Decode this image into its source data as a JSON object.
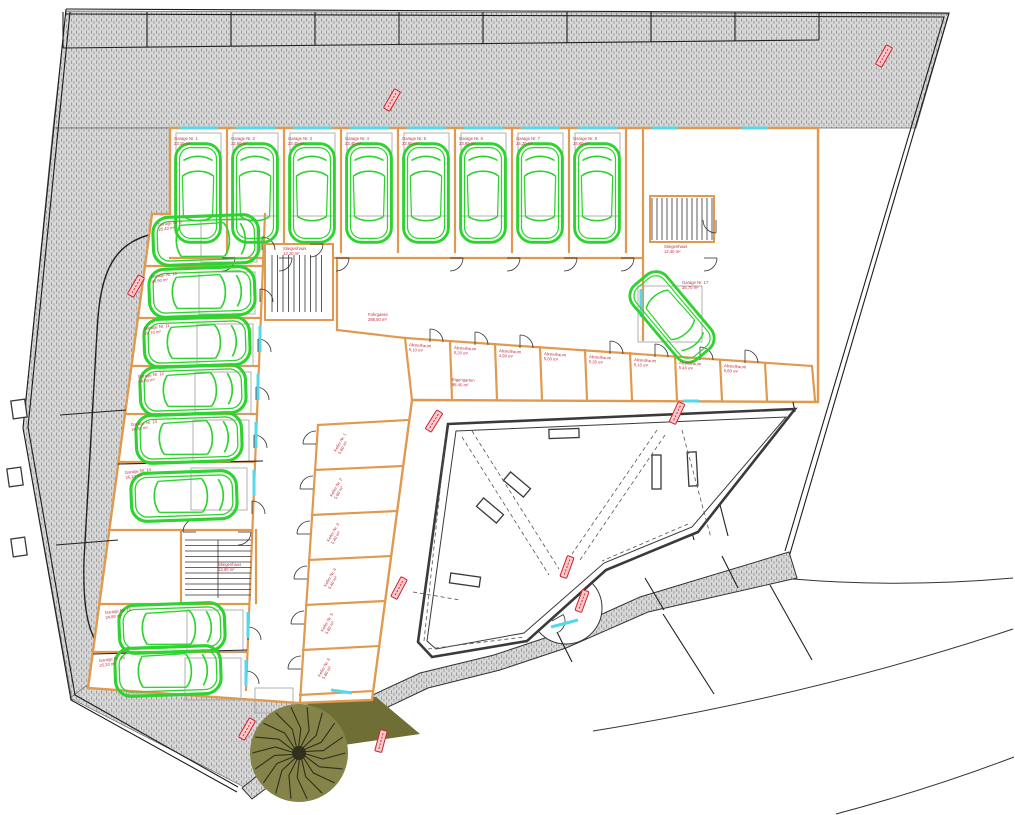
{
  "colors": {
    "wall": "#e09a50",
    "car": "#2fd32f",
    "window": "#55d8ea",
    "stamp": "#cc2233",
    "label": "#c03344",
    "hatch_bg": "#d8d8d8",
    "hatch_mark": "#9b9b9b",
    "courtyard_wall": "#3a3a3a",
    "olive": "#6e6e35",
    "tree_branches": "#30301c",
    "boundary": "#1d1d1d"
  },
  "top_stalls": {
    "x0": 63,
    "n": 9,
    "w": 84,
    "y_top": 12,
    "y_bot_left": 48,
    "y_bot_right": 40
  },
  "cars": [
    [
      198,
      193,
      0,
      1.12
    ],
    [
      255,
      193,
      0,
      1.12
    ],
    [
      312,
      193,
      0,
      1.12
    ],
    [
      369,
      193,
      0,
      1.12
    ],
    [
      426,
      193,
      0,
      1.12
    ],
    [
      483,
      193,
      0,
      1.12
    ],
    [
      540,
      193,
      0,
      1.12
    ],
    [
      597,
      193,
      0,
      1.12
    ],
    [
      206,
      240,
      88,
      1.2
    ],
    [
      202,
      292,
      88,
      1.2
    ],
    [
      197,
      342,
      88,
      1.2
    ],
    [
      193,
      390,
      88,
      1.2
    ],
    [
      189,
      438,
      88,
      1.2
    ],
    [
      184,
      496,
      88,
      1.2
    ],
    [
      172,
      628,
      88,
      1.2
    ],
    [
      168,
      671,
      88,
      1.2
    ],
    [
      672,
      317,
      140,
      1.1
    ]
  ],
  "walls": [
    [
      170,
      258,
      643,
      258
    ],
    [
      227,
      128,
      227,
      252
    ],
    [
      284,
      128,
      284,
      252
    ],
    [
      341,
      128,
      341,
      252
    ],
    [
      398,
      128,
      398,
      252
    ],
    [
      455,
      128,
      455,
      252
    ],
    [
      512,
      128,
      512,
      252
    ],
    [
      569,
      128,
      569,
      252
    ],
    [
      626,
      128,
      626,
      252
    ],
    [
      265,
      214,
      246,
      690
    ],
    [
      145,
      266,
      263,
      266
    ],
    [
      138,
      318,
      261,
      318
    ],
    [
      132,
      366,
      259,
      366
    ],
    [
      125,
      414,
      257,
      414
    ],
    [
      119,
      462,
      255,
      462
    ],
    [
      109,
      530,
      252,
      530
    ],
    [
      99,
      604,
      249,
      604
    ],
    [
      93,
      652,
      247,
      652
    ],
    [
      337,
      258,
      337,
      330
    ],
    [
      337,
      330,
      405,
      338
    ],
    [
      405,
      338,
      812,
      366
    ],
    [
      405,
      338,
      412,
      400
    ],
    [
      450,
      341,
      452,
      400
    ],
    [
      495,
      344,
      497,
      400
    ],
    [
      540,
      347,
      542,
      400
    ],
    [
      585,
      350,
      587,
      400
    ],
    [
      630,
      353,
      632,
      400
    ],
    [
      675,
      357,
      677,
      400
    ],
    [
      720,
      360,
      722,
      400
    ],
    [
      765,
      363,
      767,
      400
    ],
    [
      812,
      366,
      815,
      400
    ],
    [
      643,
      128,
      643,
      340
    ],
    [
      318,
      425,
      300,
      702
    ],
    [
      318,
      425,
      408,
      420
    ],
    [
      315,
      470,
      403,
      466
    ],
    [
      312,
      515,
      397,
      511
    ],
    [
      309,
      560,
      391,
      556
    ],
    [
      306,
      605,
      385,
      601
    ],
    [
      303,
      650,
      379,
      646
    ],
    [
      300,
      695,
      373,
      691
    ],
    [
      181,
      531,
      181,
      602
    ],
    [
      256,
      530,
      256,
      603
    ]
  ],
  "black_lines": [
    [
      645,
      578,
      664,
      610
    ],
    [
      557,
      632,
      572,
      662
    ],
    [
      722,
      556,
      738,
      588
    ],
    [
      663,
      614,
      714,
      694
    ],
    [
      770,
      585,
      812,
      660
    ],
    [
      60,
      415,
      126,
      410
    ],
    [
      56,
      545,
      118,
      540
    ],
    [
      118,
      464,
      263,
      461
    ],
    [
      93,
      654,
      247,
      650
    ],
    [
      793,
      402,
      795,
      412
    ],
    [
      665,
      427,
      694,
      540
    ],
    [
      699,
      423,
      728,
      536
    ]
  ],
  "gray_rects": [
    [
      176,
      133,
      45,
      83
    ],
    [
      233,
      133,
      45,
      83
    ],
    [
      290,
      133,
      45,
      83
    ],
    [
      347,
      133,
      45,
      83
    ],
    [
      404,
      133,
      45,
      83
    ],
    [
      461,
      133,
      45,
      83
    ],
    [
      518,
      133,
      45,
      83
    ],
    [
      575,
      133,
      45,
      83
    ],
    [
      201,
      220,
      56,
      42
    ],
    [
      199,
      272,
      56,
      42
    ],
    [
      197,
      324,
      56,
      42
    ],
    [
      195,
      372,
      56,
      42
    ],
    [
      193,
      420,
      56,
      42
    ],
    [
      191,
      468,
      56,
      42
    ],
    [
      187,
      610,
      56,
      42
    ],
    [
      185,
      658,
      56,
      42
    ],
    [
      638,
      286,
      64,
      56
    ],
    [
      255,
      688,
      38,
      25
    ]
  ],
  "wall_rects": [
    [
      650,
      196,
      64,
      46
    ],
    [
      265,
      244,
      68,
      76
    ]
  ],
  "dark_rects": [
    [
      549,
      429,
      30,
      9,
      -2
    ],
    [
      652,
      455,
      9,
      34,
      0
    ],
    [
      688,
      452,
      9,
      34,
      -3
    ],
    [
      504,
      479,
      26,
      11,
      40
    ],
    [
      477,
      505,
      26,
      11,
      40
    ],
    [
      450,
      575,
      30,
      10,
      8
    ]
  ],
  "black_rects": [
    [
      12,
      400,
      14,
      18,
      -8
    ],
    [
      8,
      468,
      14,
      18,
      -8
    ],
    [
      12,
      538,
      14,
      18,
      -8
    ]
  ],
  "stairs": [
    {
      "x": 272,
      "y": 255,
      "w": 54,
      "h": 57,
      "dir": "v",
      "step": 5.5
    },
    {
      "x": 185,
      "y": 540,
      "w": 66,
      "h": 58,
      "dir": "h",
      "step": 5.5,
      "mid": 218
    },
    {
      "x": 652,
      "y": 198,
      "w": 60,
      "h": 42,
      "dir": "v",
      "step": 5
    }
  ],
  "windows": [
    [
      179,
      128,
      218,
      128
    ],
    [
      236,
      128,
      275,
      128
    ],
    [
      293,
      128,
      332,
      128
    ],
    [
      350,
      128,
      389,
      128
    ],
    [
      407,
      128,
      446,
      128
    ],
    [
      464,
      128,
      503,
      128
    ],
    [
      521,
      128,
      560,
      128
    ],
    [
      578,
      128,
      617,
      128
    ],
    [
      652,
      128,
      678,
      128
    ],
    [
      742,
      128,
      768,
      128
    ],
    [
      641,
      289,
      641,
      317
    ],
    [
      683,
      401,
      699,
      401
    ],
    [
      260,
      326,
      260,
      352
    ],
    [
      258,
      374,
      258,
      400
    ],
    [
      256,
      422,
      256,
      448
    ],
    [
      254,
      470,
      254,
      496
    ],
    [
      248,
      612,
      248,
      638
    ],
    [
      246,
      660,
      246,
      686
    ],
    [
      331,
      690,
      352,
      693
    ],
    [
      551,
      627,
      578,
      620
    ]
  ],
  "doors": [
    [
      222,
      258,
      0
    ],
    [
      279,
      258,
      0
    ],
    [
      336,
      258,
      0
    ],
    [
      450,
      258,
      0
    ],
    [
      507,
      258,
      0
    ],
    [
      564,
      258,
      0
    ],
    [
      621,
      258,
      0
    ],
    [
      262,
      250,
      -90
    ],
    [
      260,
      302,
      -90
    ],
    [
      258,
      352,
      -90
    ],
    [
      256,
      400,
      -90
    ],
    [
      254,
      448,
      -90
    ],
    [
      252,
      514,
      -90
    ],
    [
      248,
      640,
      -90
    ],
    [
      246,
      684,
      -90
    ],
    [
      316,
      444,
      180
    ],
    [
      313,
      489,
      180
    ],
    [
      310,
      534,
      180
    ],
    [
      307,
      579,
      180
    ],
    [
      304,
      624,
      180
    ],
    [
      301,
      669,
      180
    ],
    [
      430,
      342,
      -90
    ],
    [
      475,
      345,
      -90
    ],
    [
      520,
      348,
      -90
    ],
    [
      610,
      354,
      -90
    ],
    [
      655,
      357,
      -90
    ],
    [
      700,
      360,
      -90
    ],
    [
      745,
      363,
      -90
    ],
    [
      310,
      244,
      0
    ],
    [
      196,
      532,
      180
    ],
    [
      238,
      532,
      0
    ],
    [
      716,
      220,
      90
    ],
    [
      704,
      258,
      0
    ],
    [
      552,
      621,
      -30
    ]
  ],
  "dashes": [
    [
      462,
      437,
      549,
      575
    ],
    [
      472,
      431,
      559,
      569
    ],
    [
      665,
      435,
      580,
      560
    ],
    [
      657,
      430,
      572,
      554
    ],
    [
      688,
      524,
      602,
      561
    ],
    [
      428,
      649,
      524,
      637
    ],
    [
      424,
      641,
      446,
      434
    ],
    [
      682,
      430,
      711,
      538
    ],
    [
      413,
      592,
      460,
      600
    ]
  ],
  "stamps": [
    [
      392,
      100,
      -60
    ],
    [
      884,
      56,
      -60
    ],
    [
      136,
      286,
      -60
    ],
    [
      434,
      421,
      -58
    ],
    [
      677,
      413,
      -65
    ],
    [
      399,
      588,
      -62
    ],
    [
      567,
      567,
      -70
    ],
    [
      582,
      601,
      -70
    ],
    [
      247,
      729,
      -60
    ],
    [
      381,
      741,
      -75
    ]
  ],
  "tree": {
    "cx": 299,
    "cy": 753,
    "r": 49,
    "branches": 18
  },
  "labels": [
    {
      "x": 174,
      "y": 140,
      "r": 0,
      "l": [
        "Garage Nr. 1",
        "23,10 m²"
      ]
    },
    {
      "x": 231,
      "y": 140,
      "r": 0,
      "l": [
        "Garage Nr. 2",
        "22,80 m²"
      ]
    },
    {
      "x": 288,
      "y": 140,
      "r": 0,
      "l": [
        "Garage Nr. 3",
        "23,40 m²"
      ]
    },
    {
      "x": 345,
      "y": 140,
      "r": 0,
      "l": [
        "Garage Nr. 4",
        "23,40 m²"
      ]
    },
    {
      "x": 402,
      "y": 140,
      "r": 0,
      "l": [
        "Garage Nr. 5",
        "23,60 m²"
      ]
    },
    {
      "x": 459,
      "y": 140,
      "r": 0,
      "l": [
        "Garage Nr. 6",
        "23,90 m²"
      ]
    },
    {
      "x": 516,
      "y": 140,
      "r": 0,
      "l": [
        "Garage Nr. 7",
        "24,20 m²"
      ]
    },
    {
      "x": 573,
      "y": 140,
      "r": 0,
      "l": [
        "Garage Nr. 8",
        "24,60 m²"
      ]
    },
    {
      "x": 158,
      "y": 226,
      "r": -7,
      "l": [
        "Garage Nr. 9",
        "25,40 m²"
      ]
    },
    {
      "x": 151,
      "y": 278,
      "r": -7,
      "l": [
        "Garage Nr. 10",
        "24,90 m²"
      ]
    },
    {
      "x": 144,
      "y": 330,
      "r": -7,
      "l": [
        "Garage Nr. 11",
        "24,70 m²"
      ]
    },
    {
      "x": 138,
      "y": 378,
      "r": -7,
      "l": [
        "Garage Nr. 12",
        "24,50 m²"
      ]
    },
    {
      "x": 131,
      "y": 426,
      "r": -7,
      "l": [
        "Garage Nr. 13",
        "24,30 m²"
      ]
    },
    {
      "x": 125,
      "y": 474,
      "r": -7,
      "l": [
        "Garage Nr. 14",
        "26,10 m²"
      ]
    },
    {
      "x": 105,
      "y": 614,
      "r": -7,
      "l": [
        "Garage Nr. 15",
        "24,80 m²"
      ]
    },
    {
      "x": 99,
      "y": 662,
      "r": -7,
      "l": [
        "Garage Nr. 16",
        "25,20 m²"
      ]
    },
    {
      "x": 682,
      "y": 284,
      "r": 0,
      "l": [
        "Garage Nr. 17",
        "35,70 m²"
      ]
    },
    {
      "x": 664,
      "y": 248,
      "r": 0,
      "l": [
        "Stiegenhaus",
        "12,40 m²"
      ]
    },
    {
      "x": 283,
      "y": 250,
      "r": 0,
      "l": [
        "Stiegenhaus",
        "13,20 m²"
      ]
    },
    {
      "x": 218,
      "y": 566,
      "r": 0,
      "l": [
        "Stiegenhaus",
        "13,00 m²"
      ]
    },
    {
      "x": 368,
      "y": 316,
      "r": 0,
      "l": [
        "Fahrgasse",
        "286,50 m²"
      ]
    },
    {
      "x": 452,
      "y": 381,
      "r": 2,
      "l": [
        "Eigengarten",
        "88,40 m²"
      ]
    },
    {
      "x": 409,
      "y": 346,
      "r": 4,
      "l": [
        "Abstellraum",
        "5,10 m²"
      ]
    },
    {
      "x": 454,
      "y": 349,
      "r": 4,
      "l": [
        "Abstellraum",
        "5,20 m²"
      ]
    },
    {
      "x": 499,
      "y": 352,
      "r": 4,
      "l": [
        "Abstellraum",
        "4,90 m²"
      ]
    },
    {
      "x": 544,
      "y": 355,
      "r": 4,
      "l": [
        "Abstellraum",
        "5,00 m²"
      ]
    },
    {
      "x": 589,
      "y": 358,
      "r": 4,
      "l": [
        "Abstellraum",
        "5,30 m²"
      ]
    },
    {
      "x": 634,
      "y": 361,
      "r": 4,
      "l": [
        "Abstellraum",
        "5,10 m²"
      ]
    },
    {
      "x": 679,
      "y": 364,
      "r": 4,
      "l": [
        "Abstellraum",
        "5,40 m²"
      ]
    },
    {
      "x": 724,
      "y": 367,
      "r": 4,
      "l": [
        "Abstellraum",
        "5,60 m²"
      ]
    },
    {
      "x": 336,
      "y": 452,
      "r": -60,
      "l": [
        "Keller Nr. 1",
        "5,60 m²"
      ]
    },
    {
      "x": 332,
      "y": 497,
      "r": -60,
      "l": [
        "Keller Nr. 2",
        "5,60 m²"
      ]
    },
    {
      "x": 329,
      "y": 542,
      "r": -60,
      "l": [
        "Keller Nr. 3",
        "5,40 m²"
      ]
    },
    {
      "x": 326,
      "y": 587,
      "r": -60,
      "l": [
        "Keller Nr. 4",
        "5,40 m²"
      ]
    },
    {
      "x": 323,
      "y": 632,
      "r": -60,
      "l": [
        "Keller Nr. 5",
        "5,60 m²"
      ]
    },
    {
      "x": 320,
      "y": 677,
      "r": -60,
      "l": [
        "Keller Nr. 6",
        "5,80 m²"
      ]
    }
  ]
}
